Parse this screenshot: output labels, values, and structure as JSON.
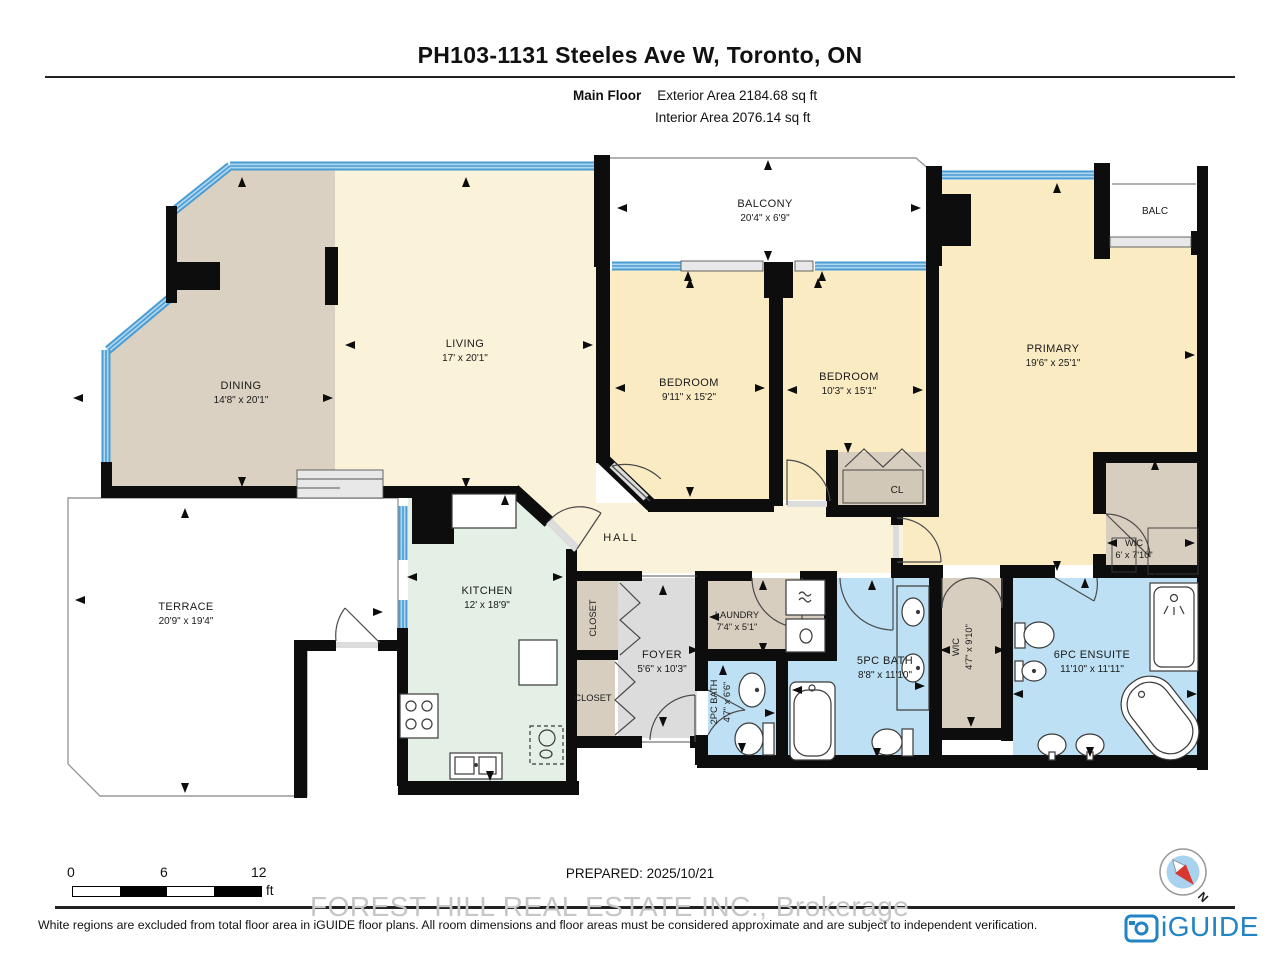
{
  "header": {
    "title": "PH103-1131 Steeles Ave W, Toronto, ON",
    "floor_label": "Main Floor",
    "exterior_area": "Exterior Area 2184.68 sq ft",
    "interior_area": "Interior Area 2076.14 sq ft"
  },
  "rooms": {
    "balcony": {
      "name": "BALCONY",
      "dims": "20'4\" x 6'9\""
    },
    "balc": {
      "name": "BALC"
    },
    "living": {
      "name": "LIVING",
      "dims": "17' x 20'1\""
    },
    "dining": {
      "name": "DINING",
      "dims": "14'8\" x 20'1\""
    },
    "bedroom1": {
      "name": "BEDROOM",
      "dims": "9'11\" x 15'2\""
    },
    "bedroom2": {
      "name": "BEDROOM",
      "dims": "10'3\" x 15'1\""
    },
    "primary": {
      "name": "PRIMARY",
      "dims": "19'6\" x 25'1\""
    },
    "wic_primary": {
      "name": "WIC",
      "dims": "6' x 7'10\""
    },
    "cl": {
      "name": "CL"
    },
    "hall": {
      "name": "HALL"
    },
    "kitchen": {
      "name": "KITCHEN",
      "dims": "12' x 18'9\""
    },
    "terrace": {
      "name": "TERRACE",
      "dims": "20'9\" x 19'4\""
    },
    "closet_upper": {
      "name": "CLOSET"
    },
    "closet_lower": {
      "name": "CLOSET"
    },
    "foyer": {
      "name": "FOYER",
      "dims": "5'6\" x 10'3\""
    },
    "laundry": {
      "name": "LAUNDRY",
      "dims": "7'4\" x 5'1\""
    },
    "bath_2pc": {
      "name": "2PC BATH",
      "dims": "4'7\" x 6'6\""
    },
    "bath_5pc": {
      "name": "5PC BATH",
      "dims": "8'8\" x 11'10\""
    },
    "wic_corridor": {
      "name": "WIC",
      "dims": "4'7\" x 9'10\""
    },
    "ensuite": {
      "name": "6PC ENSUITE",
      "dims": "11'10\" x 11'11\""
    }
  },
  "scale_bar": {
    "tick0": "0",
    "tick1": "6",
    "tick2": "12",
    "unit": "ft"
  },
  "footer": {
    "prepared": "PREPARED: 2025/10/21",
    "watermark": "FOREST HILL REAL ESTATE INC., Brokerage",
    "disclaimer": "White regions are excluded from total floor area in iGUIDE floor plans. All room dimensions and floor areas must be considered approximate and are subject to independent verification.",
    "brand": "iGUIDE",
    "compass_label": "N"
  },
  "colors": {
    "wall": "#0d0d0d",
    "window_blue": "#4A9CD3",
    "window_blue_light": "#AFD7EF",
    "living_cream": "#FBF2DA",
    "bedroom_cream": "#FAEBC3",
    "dining_tan": "#DBD1C2",
    "closet_tan": "#D8CEBF",
    "foyer_gray": "#DCDCDC",
    "kitchen_mint": "#E4EFE5",
    "bath_blue": "#BDE0F4",
    "brand_blue": "#2283C5",
    "compass_red": "#D8372F"
  }
}
